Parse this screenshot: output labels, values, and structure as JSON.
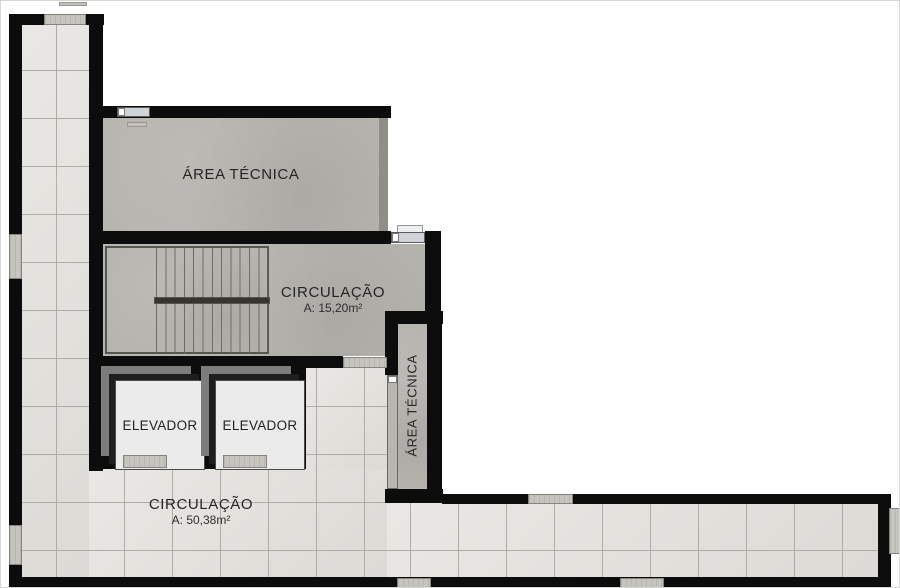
{
  "rooms": {
    "area_tecnica_top": {
      "label": "ÁREA TÉCNICA"
    },
    "circulacao_stairs": {
      "label": "CIRCULAÇÃO",
      "area": "A: 15,20m²"
    },
    "elevador_1": {
      "label": "ELEVADOR"
    },
    "elevador_2": {
      "label": "ELEVADOR"
    },
    "area_tecnica_shaft": {
      "label": "ÁREA TÉCNICA"
    },
    "circulacao_hall": {
      "label": "CIRCULAÇÃO",
      "area": "A: 50,38m²"
    }
  },
  "colors": {
    "wall": "#0c0c0c",
    "tile": "#e3e1dc",
    "tile_line": "#aeaca6",
    "concrete": "#b6b4af",
    "frame_outer": "#7c7c7c",
    "frame_inner": "#1e1e1e",
    "cab": "#ebebeb",
    "sill": "#c6c4bf",
    "marker_line": "#3b4855",
    "text": "#222222"
  }
}
